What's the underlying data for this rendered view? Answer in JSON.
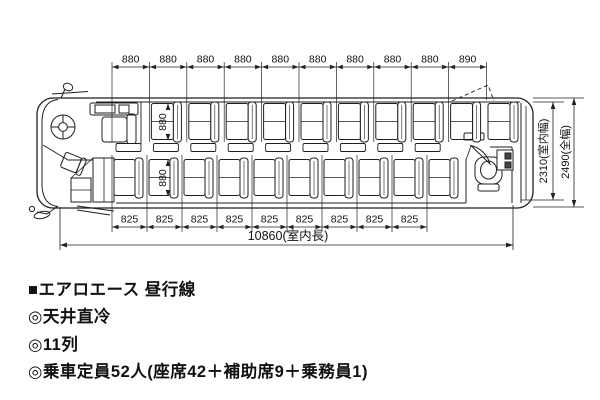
{
  "colors": {
    "line": "#1f1f1f",
    "dim": "#222222",
    "text": "#111111",
    "bg": "#ffffff"
  },
  "diagram": {
    "dims": {
      "top_segments": [
        "880",
        "880",
        "880",
        "880",
        "880",
        "880",
        "880",
        "880",
        "880",
        "890"
      ],
      "bottom_segments": [
        "825",
        "825",
        "825",
        "825",
        "825",
        "825",
        "825",
        "825",
        "825"
      ],
      "seat_width_top": "880",
      "seat_width_bottom": "880",
      "interior_length": "10860(室内長)",
      "interior_width": "2310(室内幅)",
      "overall_width": "2490(全幅)"
    },
    "counts": {
      "rows": 11,
      "top_seat_units": 10,
      "bottom_seat_units": 10,
      "aux_seats": 9
    }
  },
  "caption": {
    "title": "■エアロエース 昼行線",
    "items": [
      "◎天井直冷",
      "◎11列",
      "◎乗車定員52人(座席42＋補助席9＋乗務員1)"
    ]
  }
}
